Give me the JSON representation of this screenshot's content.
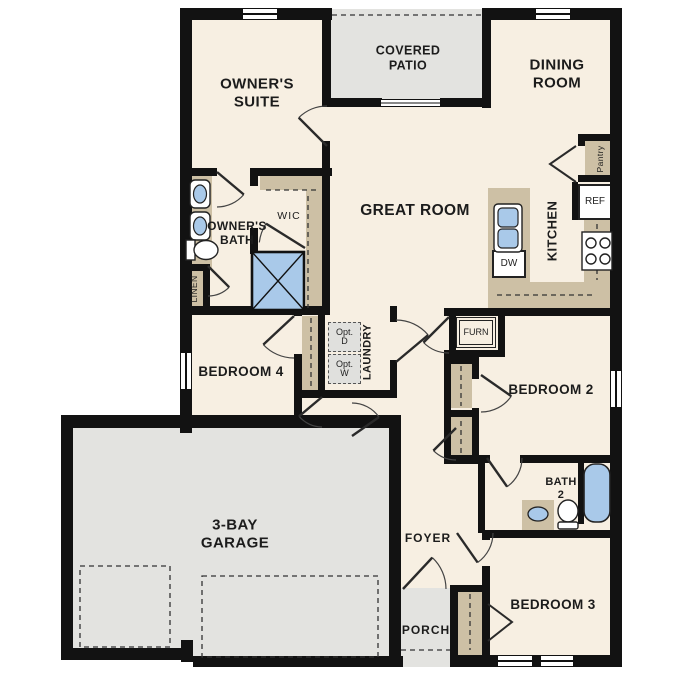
{
  "plan_title": "single-story-floor-plan",
  "rooms": {
    "owners_suite": "OWNER'S\nSUITE",
    "covered_patio": "COVERED\nPATIO",
    "dining_room": "DINING\nROOM",
    "great_room": "GREAT ROOM",
    "owners_bath": "OWNER'S\nBATH",
    "wic": "WIC",
    "kitchen": "KITCHEN",
    "pantry": "Pantry",
    "linen": "LINEN",
    "laundry": "LAUNDRY",
    "bedroom4": "BEDROOM 4",
    "bedroom2": "BEDROOM 2",
    "bath2": "BATH\n2",
    "bedroom3": "BEDROOM 3",
    "foyer": "FOYER",
    "porch": "PORCH",
    "garage": "3-BAY\nGARAGE",
    "furnace": "FURN"
  },
  "appliances": {
    "refrigerator": "REF",
    "dishwasher": "DW",
    "optional_dryer": "Opt.\nD",
    "optional_washer": "Opt.\nW"
  },
  "colors": {
    "floor": "#f7efe2",
    "hard": "#e3e3e0",
    "wall": "#121212",
    "cabinet": "#cdc0a5",
    "fixture_blue": "#a9c9e9",
    "opt_box": "#e0e0dd"
  }
}
